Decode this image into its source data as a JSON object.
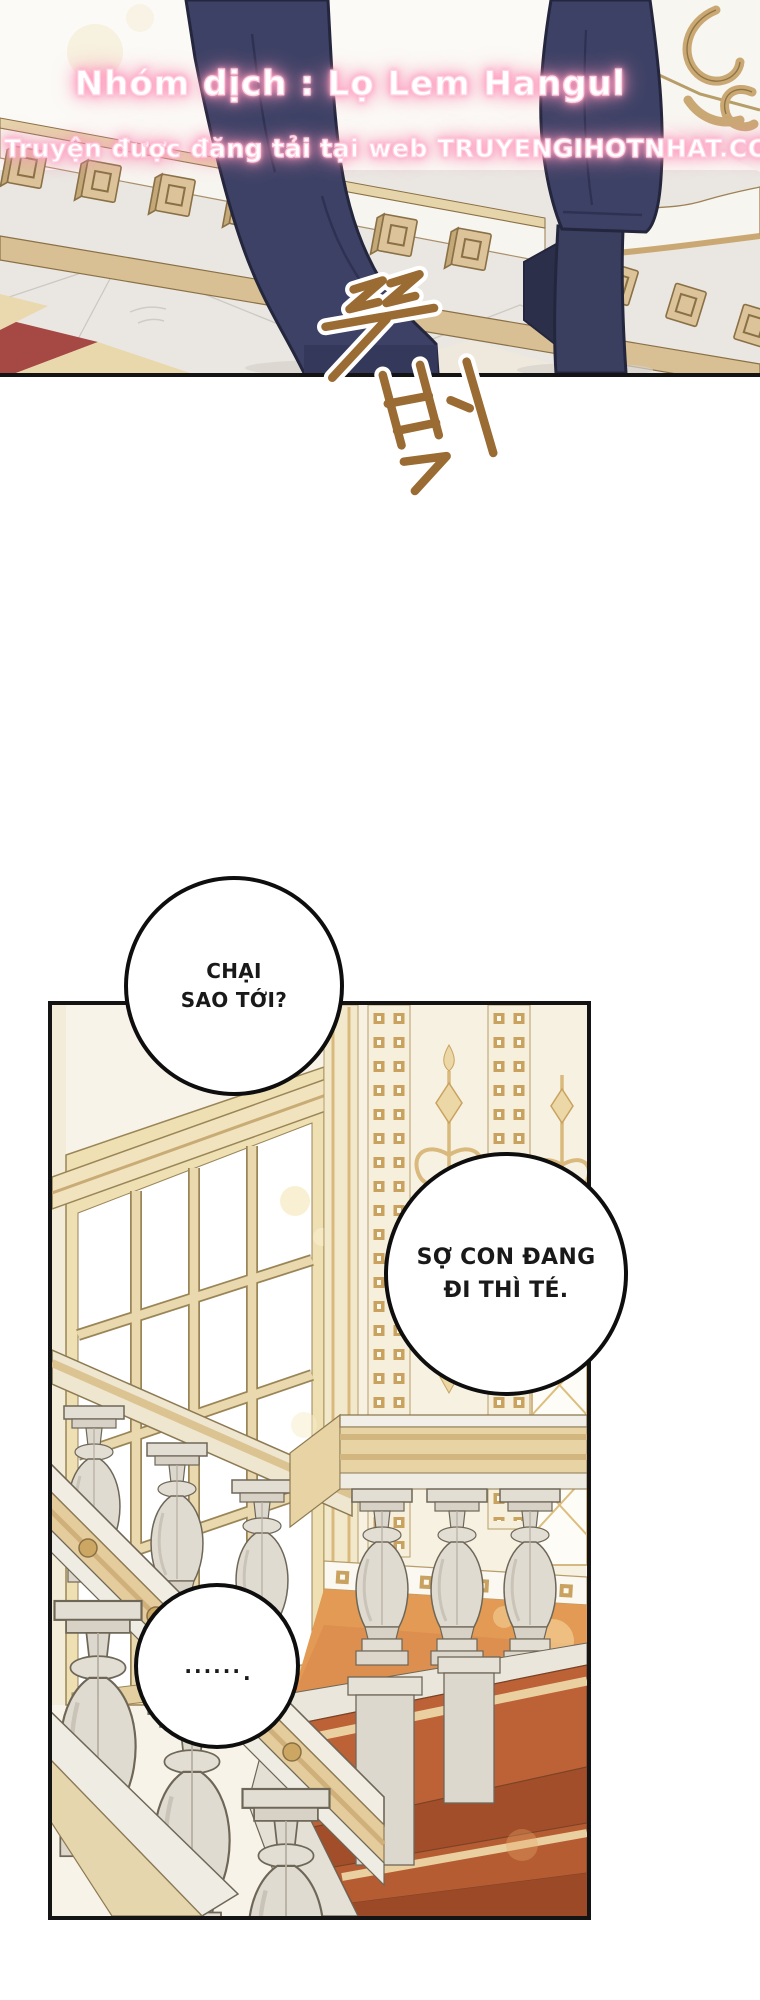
{
  "credits": {
    "line1": "Nhóm dịch : Lọ Lem Hangul",
    "line2": "Truyện được đăng tải tại web TRUYENGIHOTNHAT.COM"
  },
  "sfx": {
    "text": "뚜벅",
    "color": "#9a6b33"
  },
  "bubbles": [
    {
      "lines": [
        "CHẠI",
        "SAO TỚI?"
      ]
    },
    {
      "lines": [
        "SỢ CON ĐANG",
        "ĐI THÌ TÉ."
      ]
    },
    {
      "dots": "......",
      "period": "."
    }
  ],
  "colors": {
    "pink_glow": "#ff9dbf",
    "sfx_brown": "#9a6b33",
    "suit_navy": "#3d4165",
    "gold_trim": "#d9b97c",
    "carpet_terracotta": "#b65c33",
    "marble": "#e0dbd1",
    "panel_ink": "#141414"
  }
}
